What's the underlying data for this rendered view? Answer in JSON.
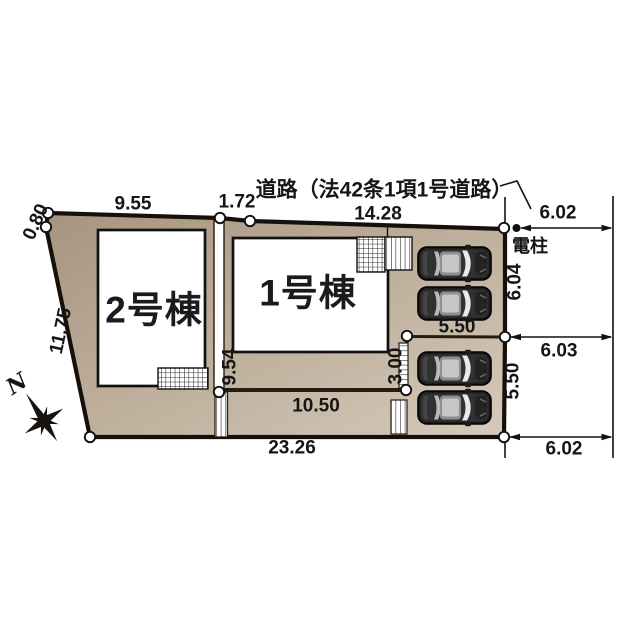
{
  "road": {
    "label": "道路（法42条1項1号道路）",
    "pole_label": "電柱"
  },
  "buildings": {
    "b1": {
      "label": "1号棟"
    },
    "b2": {
      "label": "2号棟"
    }
  },
  "compass": {
    "north_label": "N"
  },
  "dimensions": {
    "top_left_corner": "0.80",
    "top_seg1": "9.55",
    "top_seg2": "1.72",
    "top_seg3": "14.28",
    "left_edge": "11.75",
    "bottom_total": "23.26",
    "inner_bottom": "10.50",
    "inner_divider": "9.54",
    "inner_step": "3.00",
    "parking_width_top": "5.50",
    "right_edge_upper": "6.04",
    "right_edge_lower": "5.50",
    "road_width_top": "6.02",
    "road_width_mid": "6.03",
    "road_width_bottom": "6.02"
  },
  "colors": {
    "land_dark": "#a79480",
    "land_light": "#d6cabb",
    "outline": "#17100a",
    "building_fill": "#ffffff",
    "car_body": "#1c1c1c",
    "car_roof": "#9b9b9b"
  }
}
